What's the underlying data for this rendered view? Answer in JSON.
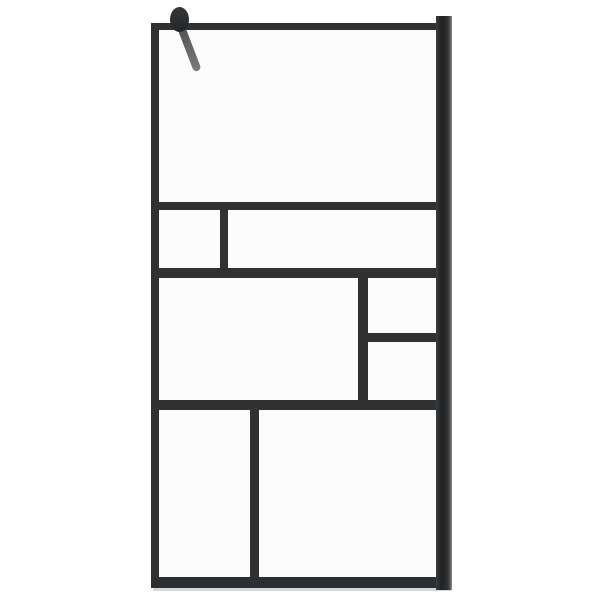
{
  "scene": {
    "background_color": "#ffffff",
    "frame_color": "#2f3133",
    "glass_tint": "rgba(247,248,249,0.5)",
    "arm_color_top": "#4d4f51",
    "arm_color_bottom": "#7b7d7f",
    "post_highlight_color": "#909294",
    "panel_count": 8
  },
  "parts": [
    {
      "name": "glass-panel-top",
      "x": 159,
      "y": 30,
      "w": 277,
      "h": 172,
      "bg": "rgba(247,248,249,0.5)"
    },
    {
      "name": "glass-panel-band2-left",
      "x": 159,
      "y": 210,
      "w": 61,
      "h": 58,
      "bg": "rgba(247,248,249,0.5)"
    },
    {
      "name": "glass-panel-band2-right",
      "x": 228,
      "y": 210,
      "w": 208,
      "h": 58,
      "bg": "rgba(247,248,249,0.5)"
    },
    {
      "name": "glass-panel-band3-left",
      "x": 159,
      "y": 278,
      "w": 199,
      "h": 122,
      "bg": "rgba(247,248,249,0.5)"
    },
    {
      "name": "glass-panel-band3-right-top",
      "x": 368,
      "y": 278,
      "w": 68,
      "h": 55,
      "bg": "rgba(247,248,249,0.5)"
    },
    {
      "name": "glass-panel-band3-right-bottom",
      "x": 368,
      "y": 342,
      "w": 68,
      "h": 58,
      "bg": "rgba(247,248,249,0.5)"
    },
    {
      "name": "glass-panel-bottom-left",
      "x": 159,
      "y": 410,
      "w": 91,
      "h": 167,
      "bg": "rgba(247,248,249,0.5)"
    },
    {
      "name": "glass-panel-bottom-right",
      "x": 259,
      "y": 410,
      "w": 177,
      "h": 167,
      "bg": "rgba(247,248,249,0.5)"
    },
    {
      "name": "floor-shadow",
      "x": 153,
      "y": 588,
      "w": 299,
      "h": 3,
      "bg": "#d4d6d7"
    },
    {
      "name": "frame-left-stile",
      "x": 151,
      "y": 23,
      "w": 8,
      "h": 565,
      "bg": "#2f3133"
    },
    {
      "name": "frame-top-rail",
      "x": 151,
      "y": 23,
      "w": 285,
      "h": 7,
      "bg": "#2f3133"
    },
    {
      "name": "frame-bottom-rail",
      "x": 151,
      "y": 577,
      "w": 285,
      "h": 11,
      "bg": "#2c2e30"
    },
    {
      "name": "frame-rail-upper",
      "x": 159,
      "y": 202,
      "w": 277,
      "h": 8,
      "bg": "#2f3133"
    },
    {
      "name": "frame-rail-middle",
      "x": 159,
      "y": 268,
      "w": 277,
      "h": 10,
      "bg": "#2f3133"
    },
    {
      "name": "frame-rail-lower",
      "x": 159,
      "y": 400,
      "w": 277,
      "h": 10,
      "bg": "#2f3133"
    },
    {
      "name": "frame-rail-right-short",
      "x": 366,
      "y": 333,
      "w": 70,
      "h": 9,
      "bg": "#2f3133"
    },
    {
      "name": "frame-divider-band2",
      "x": 220,
      "y": 210,
      "w": 8,
      "h": 58,
      "bg": "#2f3133"
    },
    {
      "name": "frame-divider-band3",
      "x": 358,
      "y": 276,
      "w": 10,
      "h": 124,
      "bg": "#2f3133"
    },
    {
      "name": "frame-divider-bottom",
      "x": 250,
      "y": 410,
      "w": 9,
      "h": 167,
      "bg": "#2f3133"
    },
    {
      "name": "wall-profile-post",
      "x": 436,
      "y": 16,
      "w": 16,
      "h": 574,
      "bg": "linear-gradient(90deg, #3a3c3e 0%, #1f2123 35%, #2b2d2f 70%, #4a4c4e 86%, #909294 100%)"
    },
    {
      "name": "support-arm",
      "x": 177,
      "y": 27,
      "w": 8,
      "h": 47,
      "bg": "linear-gradient(180deg, #4d4f51, #7b7d7f)",
      "radius": "4px",
      "rotate": -21,
      "origin": "50% 0%"
    },
    {
      "name": "support-arm-pivot-knob",
      "x": 170,
      "y": 7,
      "w": 19,
      "h": 25,
      "bg": "linear-gradient(180deg, #343638, #242527)",
      "radius": "50%"
    }
  ]
}
